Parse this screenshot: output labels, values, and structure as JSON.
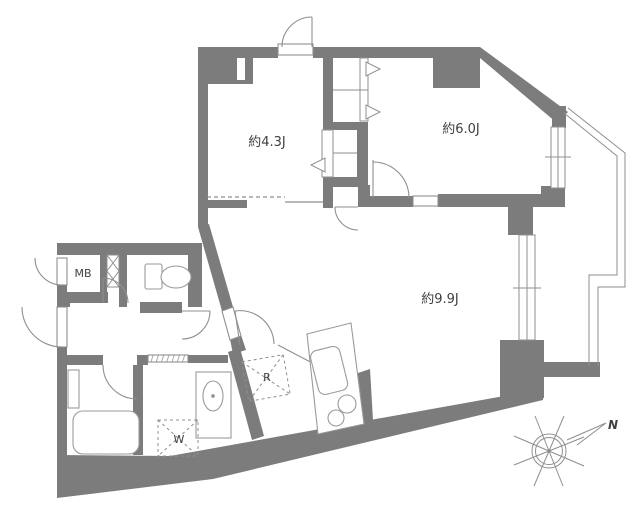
{
  "plan": {
    "type": "apartment-floor-plan",
    "labels": {
      "room_west": "約4.3J",
      "room_northeast": "約6.0J",
      "room_living": "約9.9J",
      "meter_box": "MB",
      "refrigerator": "R",
      "washing_machine": "W",
      "compass_north": "N"
    },
    "colors": {
      "wall": "#7c7c7c",
      "line": "#8f8f8f",
      "fixture_line": "#9a9a9a",
      "text": "#404040",
      "background": "#ffffff"
    }
  }
}
